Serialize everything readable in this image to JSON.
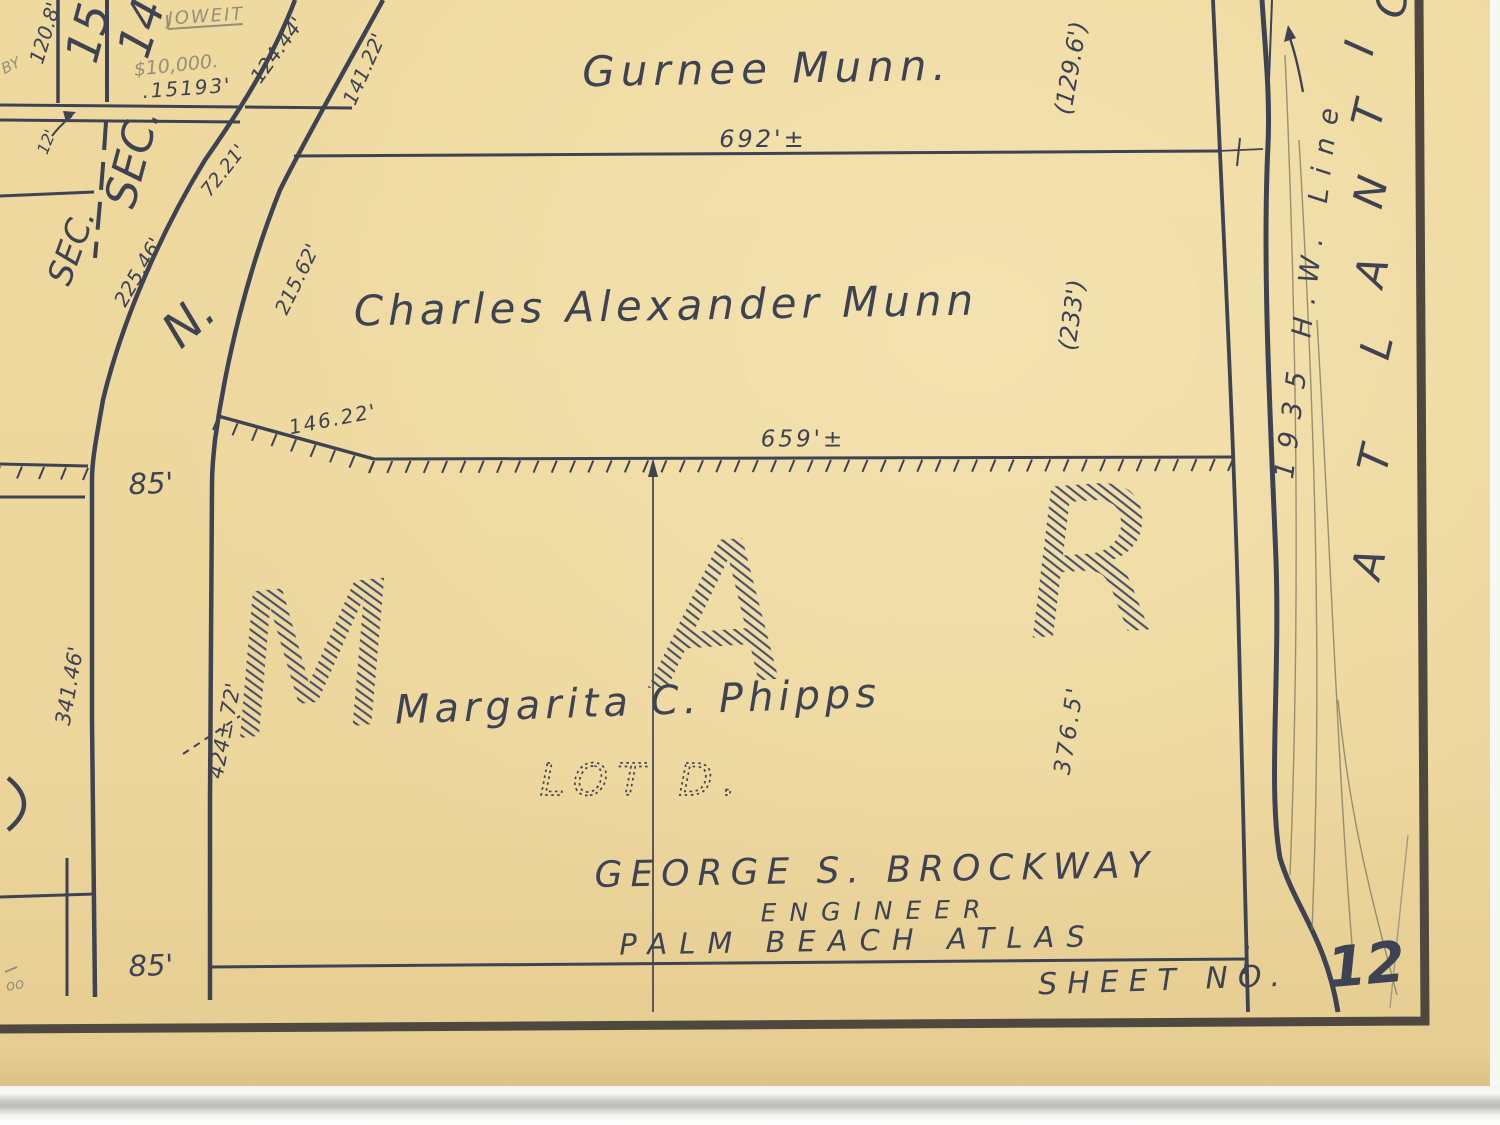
{
  "document": {
    "type": "scanned plat map page",
    "atlas": "PALM BEACH ATLAS",
    "engineer": "GEORGE S. BROCKWAY",
    "sheet": "12"
  },
  "colors": {
    "paper": "#eed99f",
    "ink": "#3e4354",
    "pencil": "#94907a",
    "border": "#4e483e"
  },
  "labels": {
    "section_15": "15",
    "section_14": "14",
    "sec_right": "SEC.",
    "sec_left": "SEC.",
    "dim_120_8": "120.8'",
    "dim_124_44": "124.44'",
    "dim_141_22": "141.22'",
    "dim_72_21": "72.21'",
    "dim_12": "12'",
    "dim_225_46": "225.46'",
    "dim_215_62": "215.62'",
    "pencil_by": "BY",
    "pencil_joweit": "JOWEIT",
    "pencil_10000": "$10,000.",
    "ink_15193": ".15193'",
    "owner_gurnee": "Gurnee Munn.",
    "dim_692": "692'±",
    "dim_129_6": "(129.6')",
    "owner_charles": "Charles Alexander Munn",
    "dim_233": "(233')",
    "dim_146_22": "146.22'",
    "dim_659": "659'±",
    "dim_85_top": "85'",
    "dim_85_bottom": "85'",
    "north": "N.",
    "owner_phipps": "Margarita C. Phipps",
    "lot": "LOT D.",
    "dim_341_46": "341.46'",
    "dim_424_72": "424± 72'",
    "dim_376_5": "376.5'",
    "pencil_oo": "oo",
    "hw_line": "1935 H.W. Line",
    "surveyor": "GEORGE S. BROCKWAY",
    "surveyor_title": "ENGINEER",
    "atlas": "PALM BEACH ATLAS",
    "sheet_label": "SHEET NO.",
    "sheet_number": "12",
    "big_m": "M",
    "big_a": "A",
    "big_r": "R"
  },
  "atlantic": [
    "A",
    "T",
    "L",
    "A",
    "N",
    "T",
    "I",
    "C"
  ]
}
